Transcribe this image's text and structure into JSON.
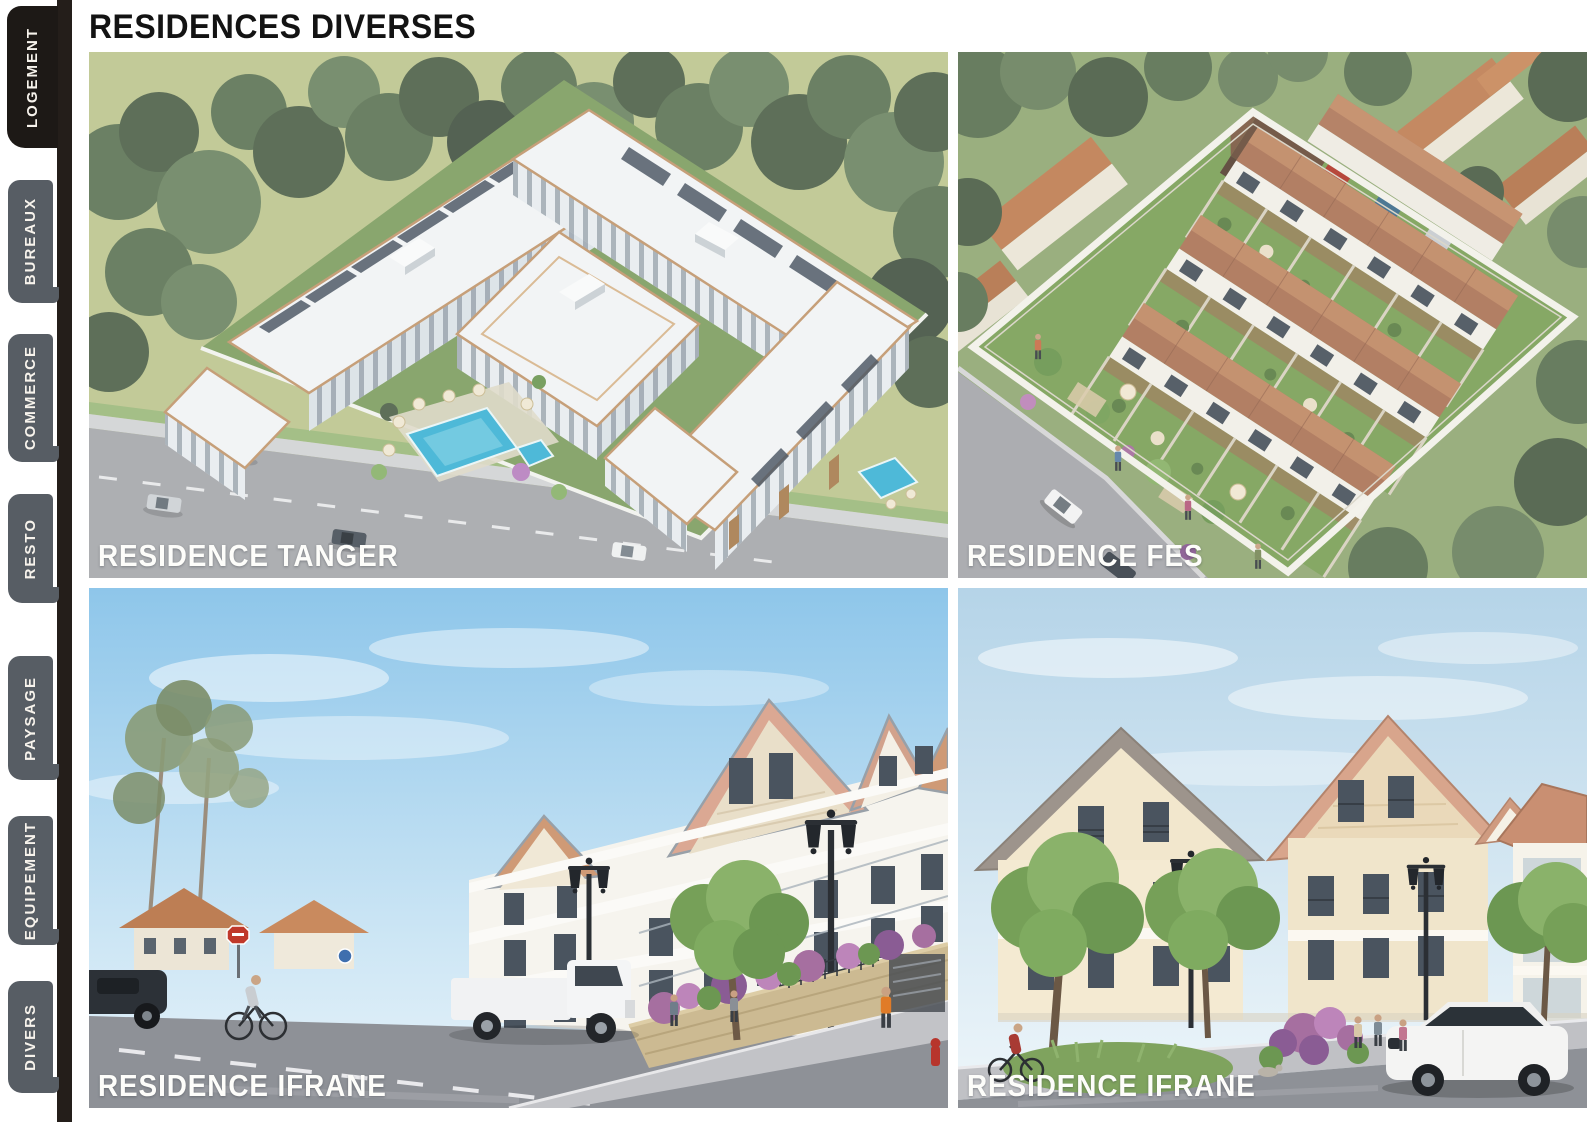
{
  "page": {
    "title": "RESIDENCES DIVERSES"
  },
  "sidebar": {
    "tabs": [
      {
        "label": "LOGEMENT",
        "active": true
      },
      {
        "label": "BUREAUX",
        "active": false
      },
      {
        "label": "COMMERCE",
        "active": false
      },
      {
        "label": "RESTO",
        "active": false
      },
      {
        "label": "PAYSAGE",
        "active": false
      },
      {
        "label": "EQUIPEMENT",
        "active": false
      },
      {
        "label": "DIVERS",
        "active": false
      }
    ]
  },
  "gallery": {
    "items": [
      {
        "id": "tanger",
        "label": "RESIDENCE TANGER"
      },
      {
        "id": "fes",
        "label": "RESIDENCE FES"
      },
      {
        "id": "ifrane-street",
        "label": "RESIDENCE IFRANE"
      },
      {
        "id": "ifrane-corner",
        "label": "RESIDENCE IFRANE"
      }
    ]
  },
  "colors": {
    "active_tab": "#1d1916",
    "inactive_tab": "#575d64",
    "tab_text": "#f7f3ec",
    "rail": "#241e1a",
    "title_text": "#131313",
    "caption_text": "#fdfdfa"
  }
}
